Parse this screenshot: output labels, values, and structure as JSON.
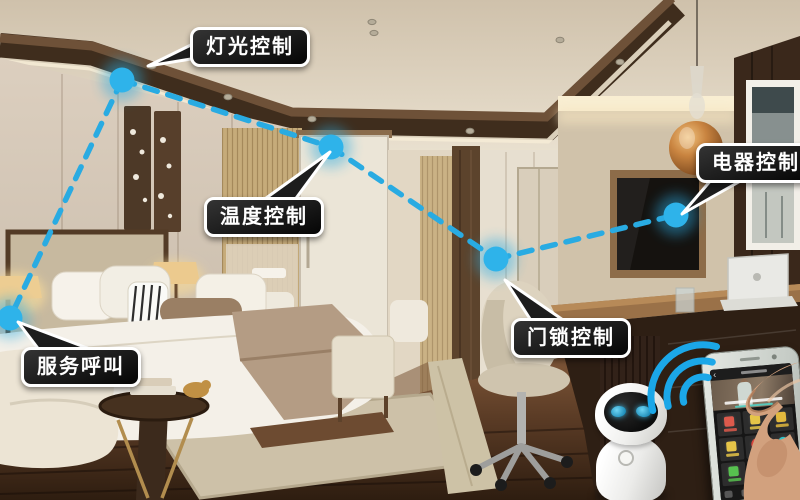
{
  "callouts": {
    "light": {
      "label": "灯光控制"
    },
    "temperature": {
      "label": "温度控制"
    },
    "appliance": {
      "label": "电器控制"
    },
    "doorlock": {
      "label": "门锁控制"
    },
    "service": {
      "label": "服务呼叫"
    }
  },
  "diagram": {
    "dot_color": "#2EB3EA",
    "dot_glow_color": "#29ABE2",
    "line_color": "#29ABE2",
    "nodes": [
      {
        "id": "light",
        "x": 122,
        "y": 80
      },
      {
        "id": "temperature",
        "x": 331,
        "y": 147
      },
      {
        "id": "appliance",
        "x": 676,
        "y": 215
      },
      {
        "id": "doorlock",
        "x": 496,
        "y": 259
      },
      {
        "id": "service",
        "x": 10,
        "y": 318
      }
    ],
    "edges": [
      [
        "light",
        "temperature"
      ],
      [
        "temperature",
        "doorlock"
      ],
      [
        "doorlock",
        "appliance"
      ],
      [
        "light",
        "service"
      ]
    ]
  },
  "colors": {
    "bubble_bg": "#1A1A1A",
    "bubble_border": "#FFFFFF",
    "bubble_text": "#FFFFFF",
    "wifi_blue": "#1BA7E8",
    "robot_eye": "#2FA8D5"
  },
  "wifi": {
    "arc_count": 3
  },
  "robot": {
    "eyes": 2
  },
  "phone_app": {
    "back_glyph": "‹",
    "tiles": [
      {
        "icon": "repair-tool-icon",
        "color": "#DD5A4C",
        "shape": "square"
      },
      {
        "icon": "cleaning-broom-icon",
        "color": "#E6C548",
        "shape": "square"
      },
      {
        "icon": "hanger-icon",
        "color": "#E2B93E",
        "shape": "square"
      },
      {
        "icon": "chat-message-icon",
        "color": "#E6C548",
        "shape": "square"
      },
      {
        "icon": "do-not-disturb-icon",
        "color": "#D9453C",
        "shape": "circle-slash"
      },
      {
        "icon": "clock-icon",
        "color": "#2EC4C9",
        "shape": "circle"
      },
      {
        "icon": "room-card-icon",
        "color": "#57C14F",
        "shape": "square"
      },
      {
        "icon": "iron-laundry-icon",
        "color": "#35B8C9",
        "shape": "square"
      },
      {
        "icon": "more-service-icon",
        "color": "#9A9A9A",
        "shape": "square"
      }
    ],
    "nav_count": 5,
    "nav_active_index": 3,
    "nav_active_color": "#2AA8E0"
  }
}
